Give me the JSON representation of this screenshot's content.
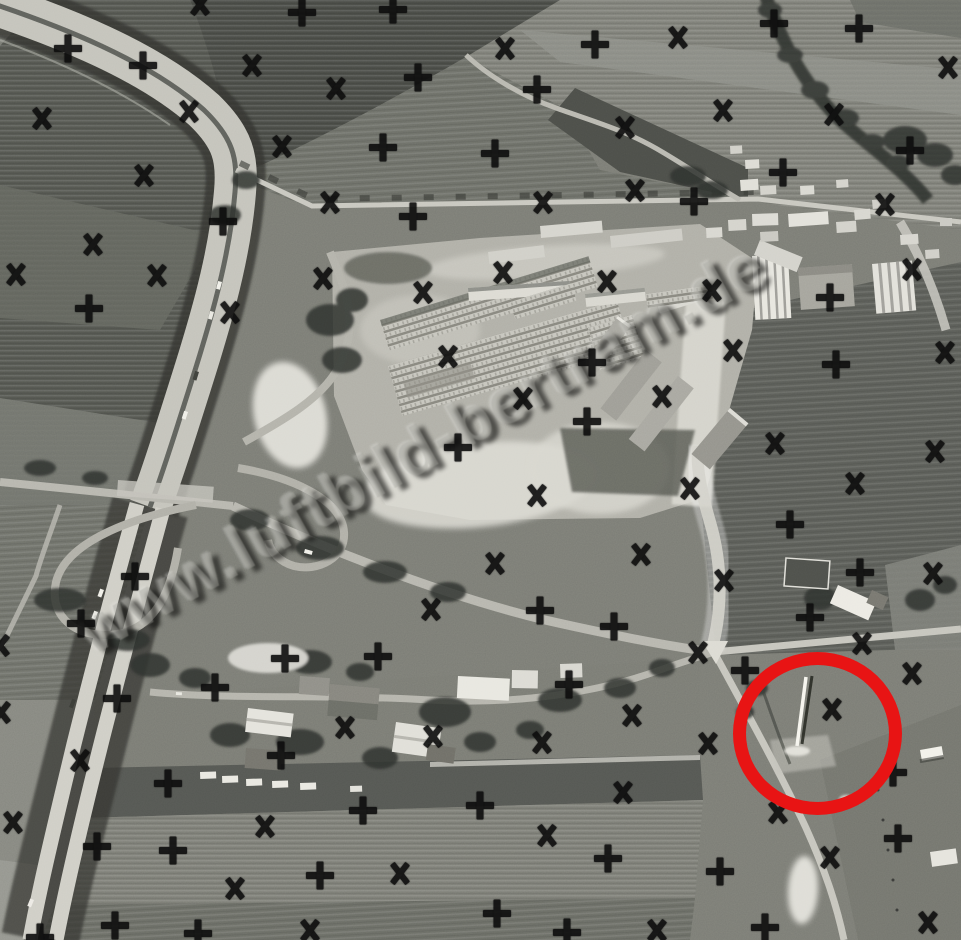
{
  "meta": {
    "kind": "black-and-white aerial photograph",
    "subject": "Autobahn interchange beside a large housing construction site with fields and a village"
  },
  "watermark": {
    "text": "www.luftbild-bertram.de",
    "color": "#a8a8a0",
    "rotation_deg": -29
  },
  "annotation": {
    "shape": "circle",
    "color": "#e81414",
    "left": 733,
    "top": 652,
    "width": 143,
    "height": 137,
    "stroke_width": 13,
    "highlights": "tall pole with shadow in meadow"
  },
  "marks": {
    "color": "#0d0d0d",
    "plus_count": 49,
    "x_count": 60,
    "items": [
      [
        "x",
        200,
        4
      ],
      [
        "+",
        302,
        12
      ],
      [
        "+",
        393,
        9
      ],
      [
        "+",
        68,
        48
      ],
      [
        "x",
        505,
        48
      ],
      [
        "+",
        595,
        44
      ],
      [
        "x",
        678,
        37
      ],
      [
        "+",
        774,
        23
      ],
      [
        "+",
        859,
        28
      ],
      [
        "+",
        143,
        65
      ],
      [
        "x",
        252,
        65
      ],
      [
        "+",
        418,
        77
      ],
      [
        "x",
        336,
        88
      ],
      [
        "+",
        537,
        89
      ],
      [
        "x",
        948,
        67
      ],
      [
        "x",
        42,
        118
      ],
      [
        "x",
        189,
        111
      ],
      [
        "x",
        723,
        110
      ],
      [
        "x",
        834,
        114
      ],
      [
        "x",
        625,
        127
      ],
      [
        "x",
        282,
        146
      ],
      [
        "+",
        383,
        147
      ],
      [
        "+",
        495,
        153
      ],
      [
        "+",
        910,
        150
      ],
      [
        "x",
        144,
        175
      ],
      [
        "+",
        783,
        172
      ],
      [
        "x",
        635,
        190
      ],
      [
        "+",
        694,
        201
      ],
      [
        "x",
        330,
        202
      ],
      [
        "x",
        543,
        202
      ],
      [
        "x",
        885,
        204
      ],
      [
        "+",
        413,
        216
      ],
      [
        "+",
        223,
        221
      ],
      [
        "x",
        93,
        244
      ],
      [
        "x",
        16,
        274
      ],
      [
        "x",
        157,
        275
      ],
      [
        "x",
        323,
        278
      ],
      [
        "x",
        503,
        272
      ],
      [
        "x",
        607,
        281
      ],
      [
        "x",
        912,
        269
      ],
      [
        "+",
        89,
        308
      ],
      [
        "x",
        230,
        312
      ],
      [
        "x",
        423,
        292
      ],
      [
        "x",
        712,
        290
      ],
      [
        "+",
        830,
        297
      ],
      [
        "x",
        733,
        350
      ],
      [
        "x",
        448,
        356
      ],
      [
        "+",
        592,
        362
      ],
      [
        "x",
        945,
        352
      ],
      [
        "+",
        836,
        364
      ],
      [
        "x",
        523,
        398
      ],
      [
        "x",
        662,
        396
      ],
      [
        "+",
        587,
        421
      ],
      [
        "+",
        458,
        447
      ],
      [
        "x",
        775,
        443
      ],
      [
        "x",
        935,
        451
      ],
      [
        "x",
        690,
        488
      ],
      [
        "x",
        537,
        495
      ],
      [
        "x",
        855,
        483
      ],
      [
        "+",
        790,
        524
      ],
      [
        "x",
        641,
        554
      ],
      [
        "x",
        495,
        563
      ],
      [
        "+",
        135,
        576
      ],
      [
        "+",
        860,
        572
      ],
      [
        "x",
        933,
        573
      ],
      [
        "x",
        724,
        580
      ],
      [
        "x",
        431,
        609
      ],
      [
        "+",
        540,
        610
      ],
      [
        "+",
        614,
        626
      ],
      [
        "+",
        810,
        617
      ],
      [
        "x",
        862,
        643
      ],
      [
        "x",
        698,
        652
      ],
      [
        "x",
        0,
        645
      ],
      [
        "+",
        81,
        623
      ],
      [
        "+",
        285,
        658
      ],
      [
        "+",
        378,
        656
      ],
      [
        "+",
        745,
        670
      ],
      [
        "x",
        912,
        673
      ],
      [
        "+",
        569,
        684
      ],
      [
        "+",
        215,
        687
      ],
      [
        "+",
        117,
        698
      ],
      [
        "x",
        1,
        712
      ],
      [
        "x",
        345,
        727
      ],
      [
        "x",
        433,
        736
      ],
      [
        "x",
        632,
        715
      ],
      [
        "x",
        832,
        709
      ],
      [
        "x",
        542,
        742
      ],
      [
        "x",
        708,
        743
      ],
      [
        "+",
        281,
        755
      ],
      [
        "x",
        80,
        760
      ],
      [
        "+",
        168,
        783
      ],
      [
        "+",
        893,
        772
      ],
      [
        "x",
        623,
        792
      ],
      [
        "x",
        13,
        822
      ],
      [
        "+",
        363,
        810
      ],
      [
        "x",
        265,
        826
      ],
      [
        "+",
        480,
        805
      ],
      [
        "x",
        778,
        812
      ],
      [
        "+",
        97,
        846
      ],
      [
        "+",
        173,
        850
      ],
      [
        "+",
        320,
        875
      ],
      [
        "x",
        400,
        873
      ],
      [
        "+",
        898,
        838
      ],
      [
        "x",
        547,
        835
      ],
      [
        "+",
        608,
        858
      ],
      [
        "+",
        720,
        871
      ],
      [
        "x",
        830,
        857
      ],
      [
        "x",
        235,
        888
      ],
      [
        "+",
        115,
        925
      ],
      [
        "+",
        198,
        933
      ],
      [
        "x",
        310,
        930
      ],
      [
        "+",
        40,
        937
      ],
      [
        "+",
        497,
        913
      ],
      [
        "x",
        657,
        930
      ],
      [
        "+",
        567,
        932
      ],
      [
        "+",
        765,
        927
      ],
      [
        "x",
        928,
        922
      ]
    ]
  },
  "scene": {
    "elements": [
      "autobahn-with-tree-fringe",
      "cloverleaf-interchange",
      "housing-construction-site",
      "apartment-slab-blocks",
      "high-rise-towers",
      "town-edge-houses",
      "village-houses",
      "field-patchwork",
      "crossroads",
      "circled-pole"
    ]
  }
}
